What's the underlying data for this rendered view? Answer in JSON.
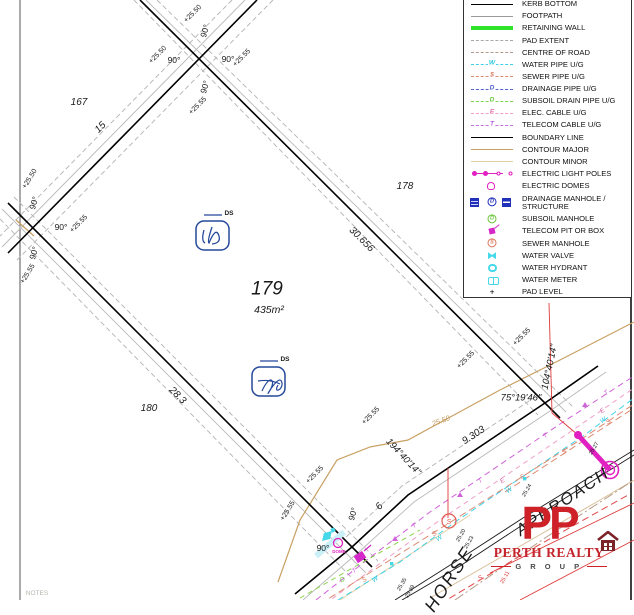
{
  "colors": {
    "boundary": "#000000",
    "footpath": "#9a9a9a",
    "pad_extent": "#a8a8a8",
    "retaining_wall": "#2fe32b",
    "water": "#3ed2e8",
    "sewer": "#dd8a70",
    "sewer_alt": "#e04848",
    "drainage": "#5063d0",
    "subsoil": "#7fd348",
    "elec": "#f0a0c8",
    "telecom": "#c072d6",
    "electric_symbols": "#e020c0",
    "drainage_manhole": "#2130b8",
    "contour_major": "#c9a063",
    "contour_minor": "#e3cfa6",
    "logo_red": "#cf2128",
    "logo_house": "#7c2328"
  },
  "legend": {
    "items": [
      {
        "label": "KERB BOTTOM",
        "glyph": ""
      },
      {
        "label": "FOOTPATH",
        "glyph": ""
      },
      {
        "label": "RETAINING WALL",
        "glyph": ""
      },
      {
        "label": "PAD EXTENT",
        "glyph": ""
      },
      {
        "label": "CENTRE OF ROAD",
        "glyph": ""
      },
      {
        "label": "WATER PIPE U/G",
        "glyph": "W"
      },
      {
        "label": "SEWER PIPE U/G",
        "glyph": "$"
      },
      {
        "label": "DRAINAGE PIPE U/G",
        "glyph": "D"
      },
      {
        "label": "SUBSOIL DRAIN PIPE U/G",
        "glyph": "D"
      },
      {
        "label": "ELEC. CABLE U/G",
        "glyph": "E"
      },
      {
        "label": "TELECOM CABLE U/G",
        "glyph": "T"
      },
      {
        "label": "BOUNDARY LINE",
        "glyph": ""
      },
      {
        "label": "CONTOUR MAJOR",
        "glyph": ""
      },
      {
        "label": "CONTOUR MINOR",
        "glyph": ""
      },
      {
        "label": "ELECTRIC LIGHT POLES",
        "glyph": ""
      },
      {
        "label": "ELECTRIC DOMES",
        "glyph": ""
      },
      {
        "label": "DRAINAGE MANHOLE / STRUCTURE",
        "glyph": "D"
      },
      {
        "label": "SUBSOIL MANHOLE",
        "glyph": "D"
      },
      {
        "label": "TELECOM PIT OR BOX",
        "glyph": ""
      },
      {
        "label": "SEWER MANHOLE",
        "glyph": "S"
      },
      {
        "label": "WATER VALVE",
        "glyph": ""
      },
      {
        "label": "WATER HYDRANT",
        "glyph": ""
      },
      {
        "label": "WATER METER",
        "glyph": ""
      },
      {
        "label": "PAD LEVEL",
        "glyph": "+"
      }
    ]
  },
  "plan": {
    "markers": {
      "t": "T",
      "w": "W",
      "s": "S",
      "d": "D",
      "e": "E"
    },
    "ds_label": "DS",
    "labels": [
      {
        "t": "167",
        "x": 79,
        "y": 103,
        "r": 0,
        "s": 10
      },
      {
        "t": "178",
        "x": 405,
        "y": 187,
        "r": 0,
        "s": 10
      },
      {
        "t": "180",
        "x": 149,
        "y": 409,
        "r": 0,
        "s": 10
      },
      {
        "t": "179",
        "x": 267,
        "y": 289,
        "r": 0,
        "s": 19
      },
      {
        "t": "435m²",
        "x": 269,
        "y": 310,
        "r": 0,
        "s": 10.5
      },
      {
        "t": "15",
        "x": 101,
        "y": 128,
        "r": -45,
        "s": 10
      },
      {
        "t": "28.3",
        "x": 177,
        "y": 396,
        "r": 45,
        "s": 10
      },
      {
        "t": "30.656",
        "x": 361,
        "y": 240,
        "r": 45,
        "s": 10
      },
      {
        "t": "9.303",
        "x": 474,
        "y": 436,
        "r": -33,
        "s": 10
      },
      {
        "t": "6",
        "x": 380,
        "y": 507,
        "r": -48,
        "s": 10
      },
      {
        "t": "194°40'14\"",
        "x": 403,
        "y": 457,
        "r": 47,
        "s": 9.5
      },
      {
        "t": "104°40'14\"",
        "x": 550,
        "y": 367,
        "r": -78,
        "s": 9.5
      },
      {
        "t": "75°19'46\"",
        "x": 521,
        "y": 398,
        "r": 0,
        "s": 9.5
      },
      {
        "t": "+25.50",
        "x": 193,
        "y": 14,
        "r": -45,
        "s": 7,
        "u": 1
      },
      {
        "t": "90°",
        "x": 205,
        "y": 31,
        "r": -73,
        "s": 8.5,
        "u": 1
      },
      {
        "t": "+25.50",
        "x": 158,
        "y": 55,
        "r": -45,
        "s": 7,
        "u": 1
      },
      {
        "t": "90°",
        "x": 174,
        "y": 60,
        "r": 0,
        "s": 8.5,
        "u": 1
      },
      {
        "t": "90°",
        "x": 228,
        "y": 59,
        "r": 0,
        "s": 8.5,
        "u": 1
      },
      {
        "t": "+25.55",
        "x": 242,
        "y": 58,
        "r": -45,
        "s": 7,
        "u": 1
      },
      {
        "t": "90°",
        "x": 205,
        "y": 87,
        "r": -73,
        "s": 8.5,
        "u": 1
      },
      {
        "t": "+25.55",
        "x": 198,
        "y": 106,
        "r": -45,
        "s": 7,
        "u": 1
      },
      {
        "t": "+25.50",
        "x": 30,
        "y": 179,
        "r": -58,
        "s": 7,
        "u": 1
      },
      {
        "t": "90°",
        "x": 34,
        "y": 203,
        "r": -73,
        "s": 8.5,
        "u": 1
      },
      {
        "t": "90°",
        "x": 61,
        "y": 227,
        "r": 0,
        "s": 8.5,
        "u": 1
      },
      {
        "t": "+25.55",
        "x": 79,
        "y": 224,
        "r": -45,
        "s": 7,
        "u": 1
      },
      {
        "t": "90°",
        "x": 34,
        "y": 253,
        "r": -73,
        "s": 8.5,
        "u": 1
      },
      {
        "t": "+25.55",
        "x": 28,
        "y": 274,
        "r": -58,
        "s": 7,
        "u": 1
      },
      {
        "t": "+25.55",
        "x": 315,
        "y": 475,
        "r": -45,
        "s": 7,
        "u": 1
      },
      {
        "t": "+25.55",
        "x": 288,
        "y": 511,
        "r": -58,
        "s": 7,
        "u": 1
      },
      {
        "t": "90°",
        "x": 323,
        "y": 548,
        "r": 0,
        "s": 8.5,
        "u": 1
      },
      {
        "t": "90°",
        "x": 353,
        "y": 514,
        "r": -73,
        "s": 8.5,
        "u": 1
      },
      {
        "t": "+25.55",
        "x": 371,
        "y": 416,
        "r": -45,
        "s": 7,
        "u": 1
      },
      {
        "t": "+25.55",
        "x": 466,
        "y": 360,
        "r": -45,
        "s": 7,
        "u": 1
      },
      {
        "t": "+25.55",
        "x": 522,
        "y": 337,
        "r": -45,
        "s": 7,
        "u": 1
      },
      {
        "t": "25.50",
        "x": 441,
        "y": 421,
        "r": -20,
        "s": 7.5,
        "c": "#c59a5f"
      },
      {
        "t": "25.20",
        "x": 462,
        "y": 536,
        "r": -60,
        "s": 5.5,
        "u": 1
      },
      {
        "t": "25.23",
        "x": 470,
        "y": 543,
        "r": -60,
        "s": 5.5,
        "u": 1
      },
      {
        "t": "25.35",
        "x": 403,
        "y": 585,
        "r": -60,
        "s": 5.5,
        "u": 1
      },
      {
        "t": "25.39",
        "x": 411,
        "y": 592,
        "r": -60,
        "s": 5.5,
        "u": 1
      },
      {
        "t": "25.24",
        "x": 528,
        "y": 491,
        "r": -60,
        "s": 5.5,
        "u": 1
      },
      {
        "t": "25.11",
        "x": 506,
        "y": 578,
        "r": -60,
        "s": 5.5,
        "c": "#e03a3a",
        "u": 1
      },
      {
        "t": "25.27",
        "x": 595,
        "y": 449,
        "r": -60,
        "s": 5.5,
        "u": 1
      },
      {
        "t": "DOME",
        "x": 339,
        "y": 552,
        "r": 0,
        "s": 4.5,
        "c": "#e020c0",
        "u": 1,
        "w": 1
      },
      {
        "t": "HORSE",
        "x": 449,
        "y": 579,
        "r": -57,
        "s": 18,
        "ls": 2
      },
      {
        "t": "APPROACH",
        "x": 563,
        "y": 502,
        "r": -34,
        "s": 16.5,
        "ls": 2
      },
      {
        "t": "NOTES",
        "x": 37,
        "y": 594,
        "r": 0,
        "s": 6.5,
        "c": "#b5b5ae",
        "u": 1
      },
      {
        "t": "DS",
        "x": 229,
        "y": 214,
        "r": 0,
        "s": 6.5,
        "u": 1,
        "w": 1
      },
      {
        "t": "DS",
        "x": 285,
        "y": 360,
        "r": 0,
        "s": 6.5,
        "u": 1,
        "w": 1
      }
    ]
  },
  "logo": {
    "pp": "PP",
    "name": "PERTH REALTY",
    "group": "G R O U P"
  }
}
